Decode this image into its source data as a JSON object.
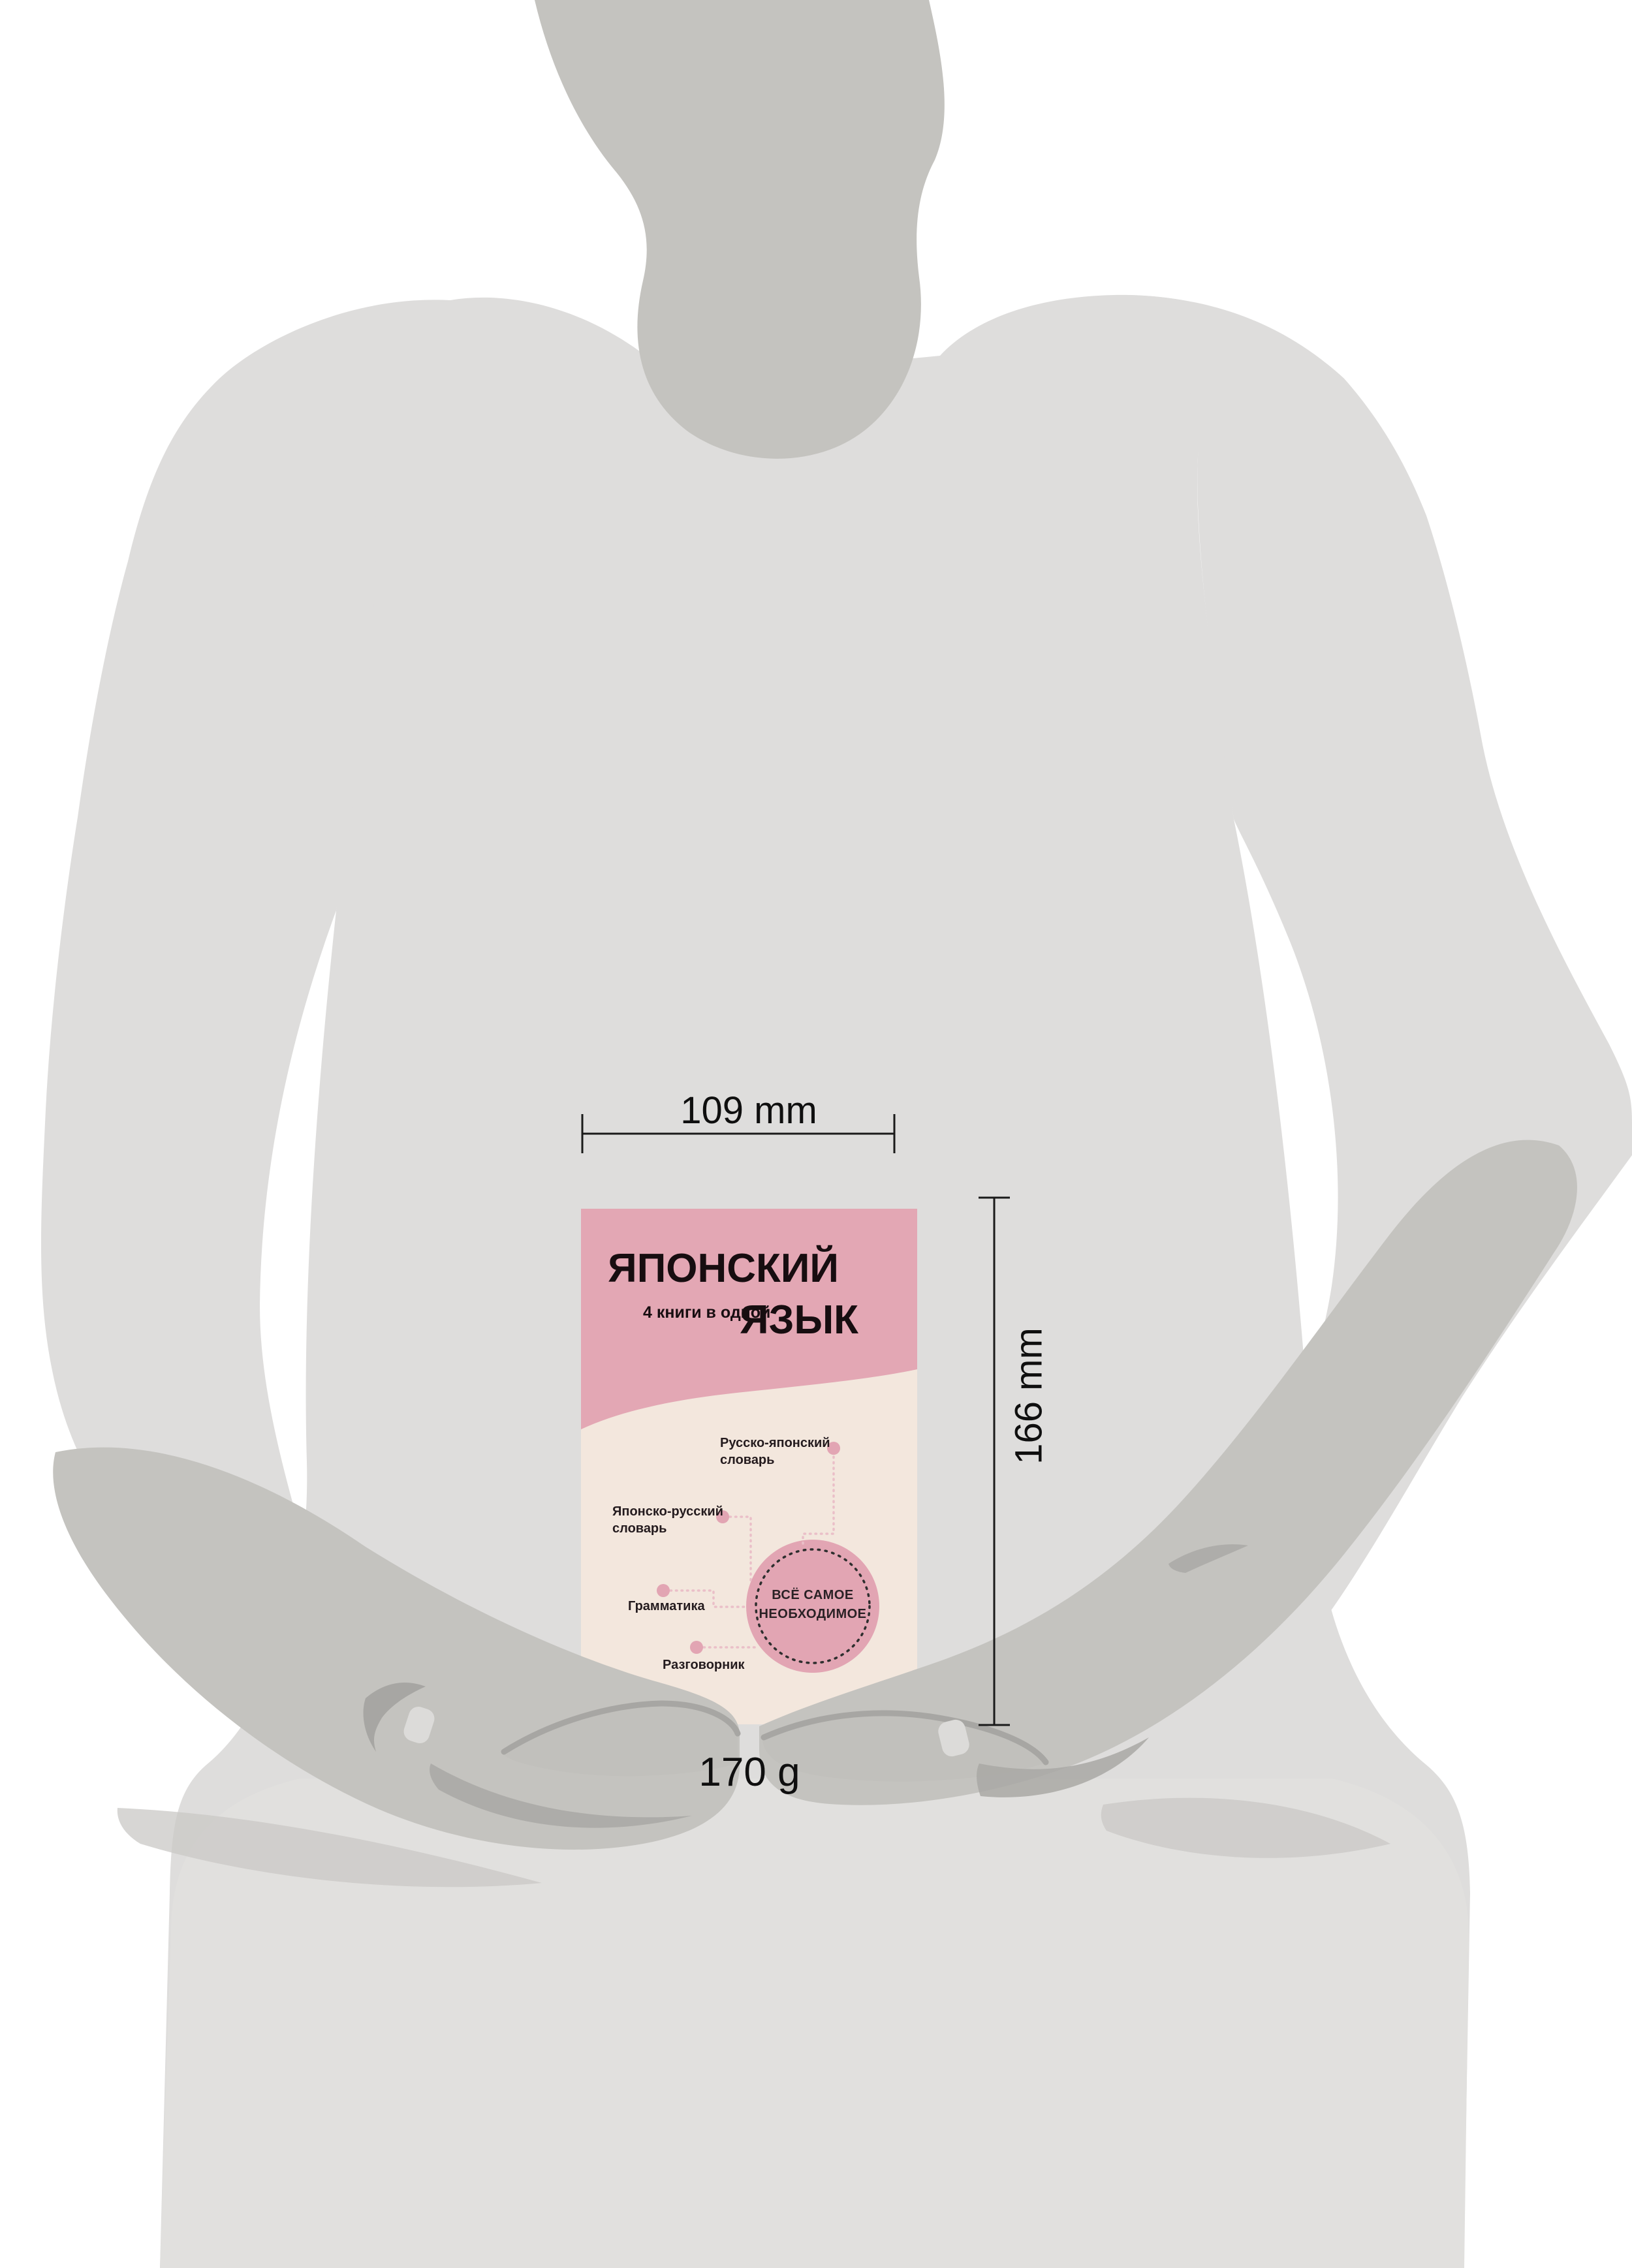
{
  "figure": {
    "description": "book size mockup held by gray human silhouette"
  },
  "dimensions": {
    "width_label": "109 mm",
    "height_label": "166 mm",
    "weight_label": "170 g"
  },
  "book": {
    "title_line1": "ЯПОНСКИЙ",
    "title_line2": "ЯЗЫК",
    "subtitle": "4 книги в одной",
    "badge": {
      "line1": "ВСЁ САМОЕ",
      "line2": "НЕОБХОДИМОЕ"
    },
    "features": [
      {
        "line1": "Русско-японский",
        "line2": "словарь"
      },
      {
        "line1": "Японско-русский",
        "line2": "словарь"
      },
      {
        "line1": "Грамматика",
        "line2": ""
      },
      {
        "line1": "Разговорник",
        "line2": ""
      }
    ]
  },
  "colors": {
    "background": "#ffffff",
    "body_gray": "#dedddc",
    "skin_gray": "#c4c3bf",
    "skirt_gray": "#e1e0de",
    "cover_pink": "#e3a7b4",
    "cover_cream": "#f3e7dd",
    "badge_pink": "#e2a5b3",
    "connector_pink": "#eabfc8",
    "ink": "#0f0f0f"
  }
}
